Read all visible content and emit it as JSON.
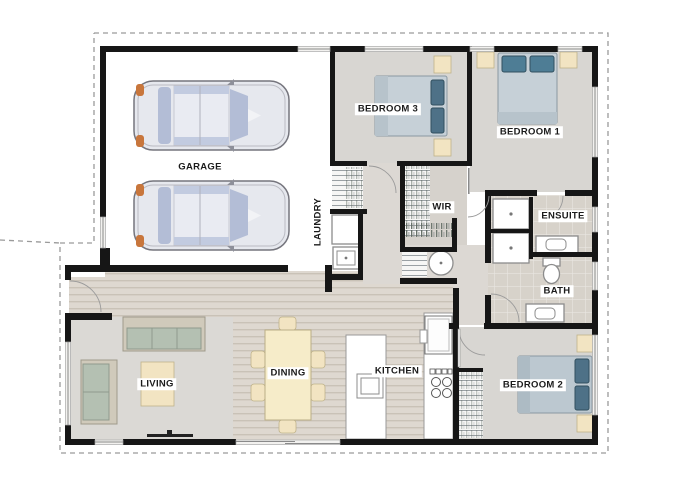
{
  "floorplan": {
    "rooms": {
      "garage": "GARAGE",
      "laundry": "LAUNDRY",
      "bedroom3": "BEDROOM 3",
      "bedroom1": "BEDROOM 1",
      "wir": "WIR",
      "ensuite": "ENSUITE",
      "bath": "BATH",
      "bedroom2": "BEDROOM 2",
      "living": "LIVING",
      "dining": "DINING",
      "kitchen": "KITCHEN"
    },
    "fixtures": {
      "garage_cars": 2,
      "beds": 3,
      "sofas": 2,
      "dining_chairs": 6,
      "showers": 2,
      "toilets": 1,
      "vanities": 2,
      "kitchen_island_sink": 1,
      "cooktop_burners": 4,
      "hot_water_cylinder": 1
    },
    "colors": {
      "wall": "#161616",
      "carpet": "#d8d6d2",
      "hall": "#dcd8d3",
      "accent_cream": "#f2e4c2",
      "sofa_green": "#b4c0b2",
      "bed_blue": "#c6d0d7",
      "pillow_teal": "#4e7d95",
      "car_body": "#e6e8ee",
      "car_window": "#b3bdd6",
      "car_accent": "#c8763c",
      "boundary_dash": "#9a9a9a"
    }
  }
}
